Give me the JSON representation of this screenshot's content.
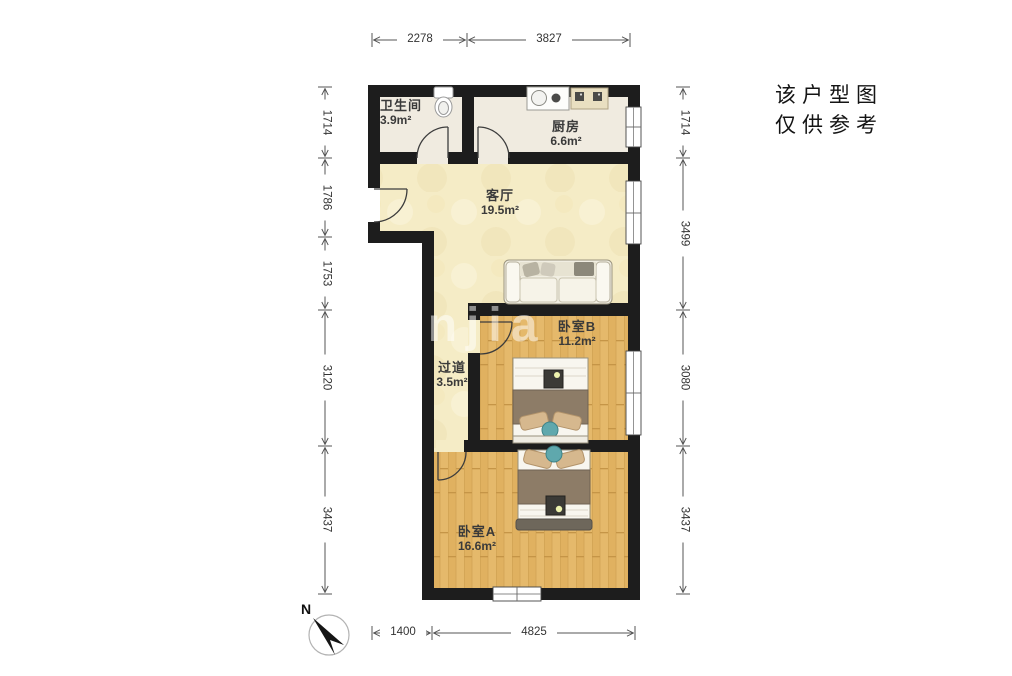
{
  "disclaimer": {
    "line1": "该户型图",
    "line2": "仅供参考"
  },
  "watermark": "anjia",
  "compass": {
    "label": "N"
  },
  "rooms": {
    "bathroom": {
      "name": "卫生间",
      "area": "3.9m²"
    },
    "kitchen": {
      "name": "厨房",
      "area": "6.6m²"
    },
    "living": {
      "name": "客厅",
      "area": "19.5m²"
    },
    "hallway": {
      "name": "过道",
      "area": "3.5m²"
    },
    "bedroom_b": {
      "name": "卧室B",
      "area": "11.2m²"
    },
    "bedroom_a": {
      "name": "卧室A",
      "area": "16.6m²"
    }
  },
  "dimensions": {
    "top": [
      "2278",
      "3827"
    ],
    "left": [
      "1714",
      "1786",
      "1753",
      "3120",
      "3437"
    ],
    "right": [
      "1714",
      "3499",
      "3080",
      "3437"
    ],
    "bottom": [
      "1400",
      "4825"
    ]
  },
  "colors": {
    "wall": "#1d1d1d",
    "living_floor": "#f5ecc6",
    "tile_floor": "#f0ebe0",
    "wood_floor": "#e5b96b",
    "dimension_line": "#555555"
  }
}
